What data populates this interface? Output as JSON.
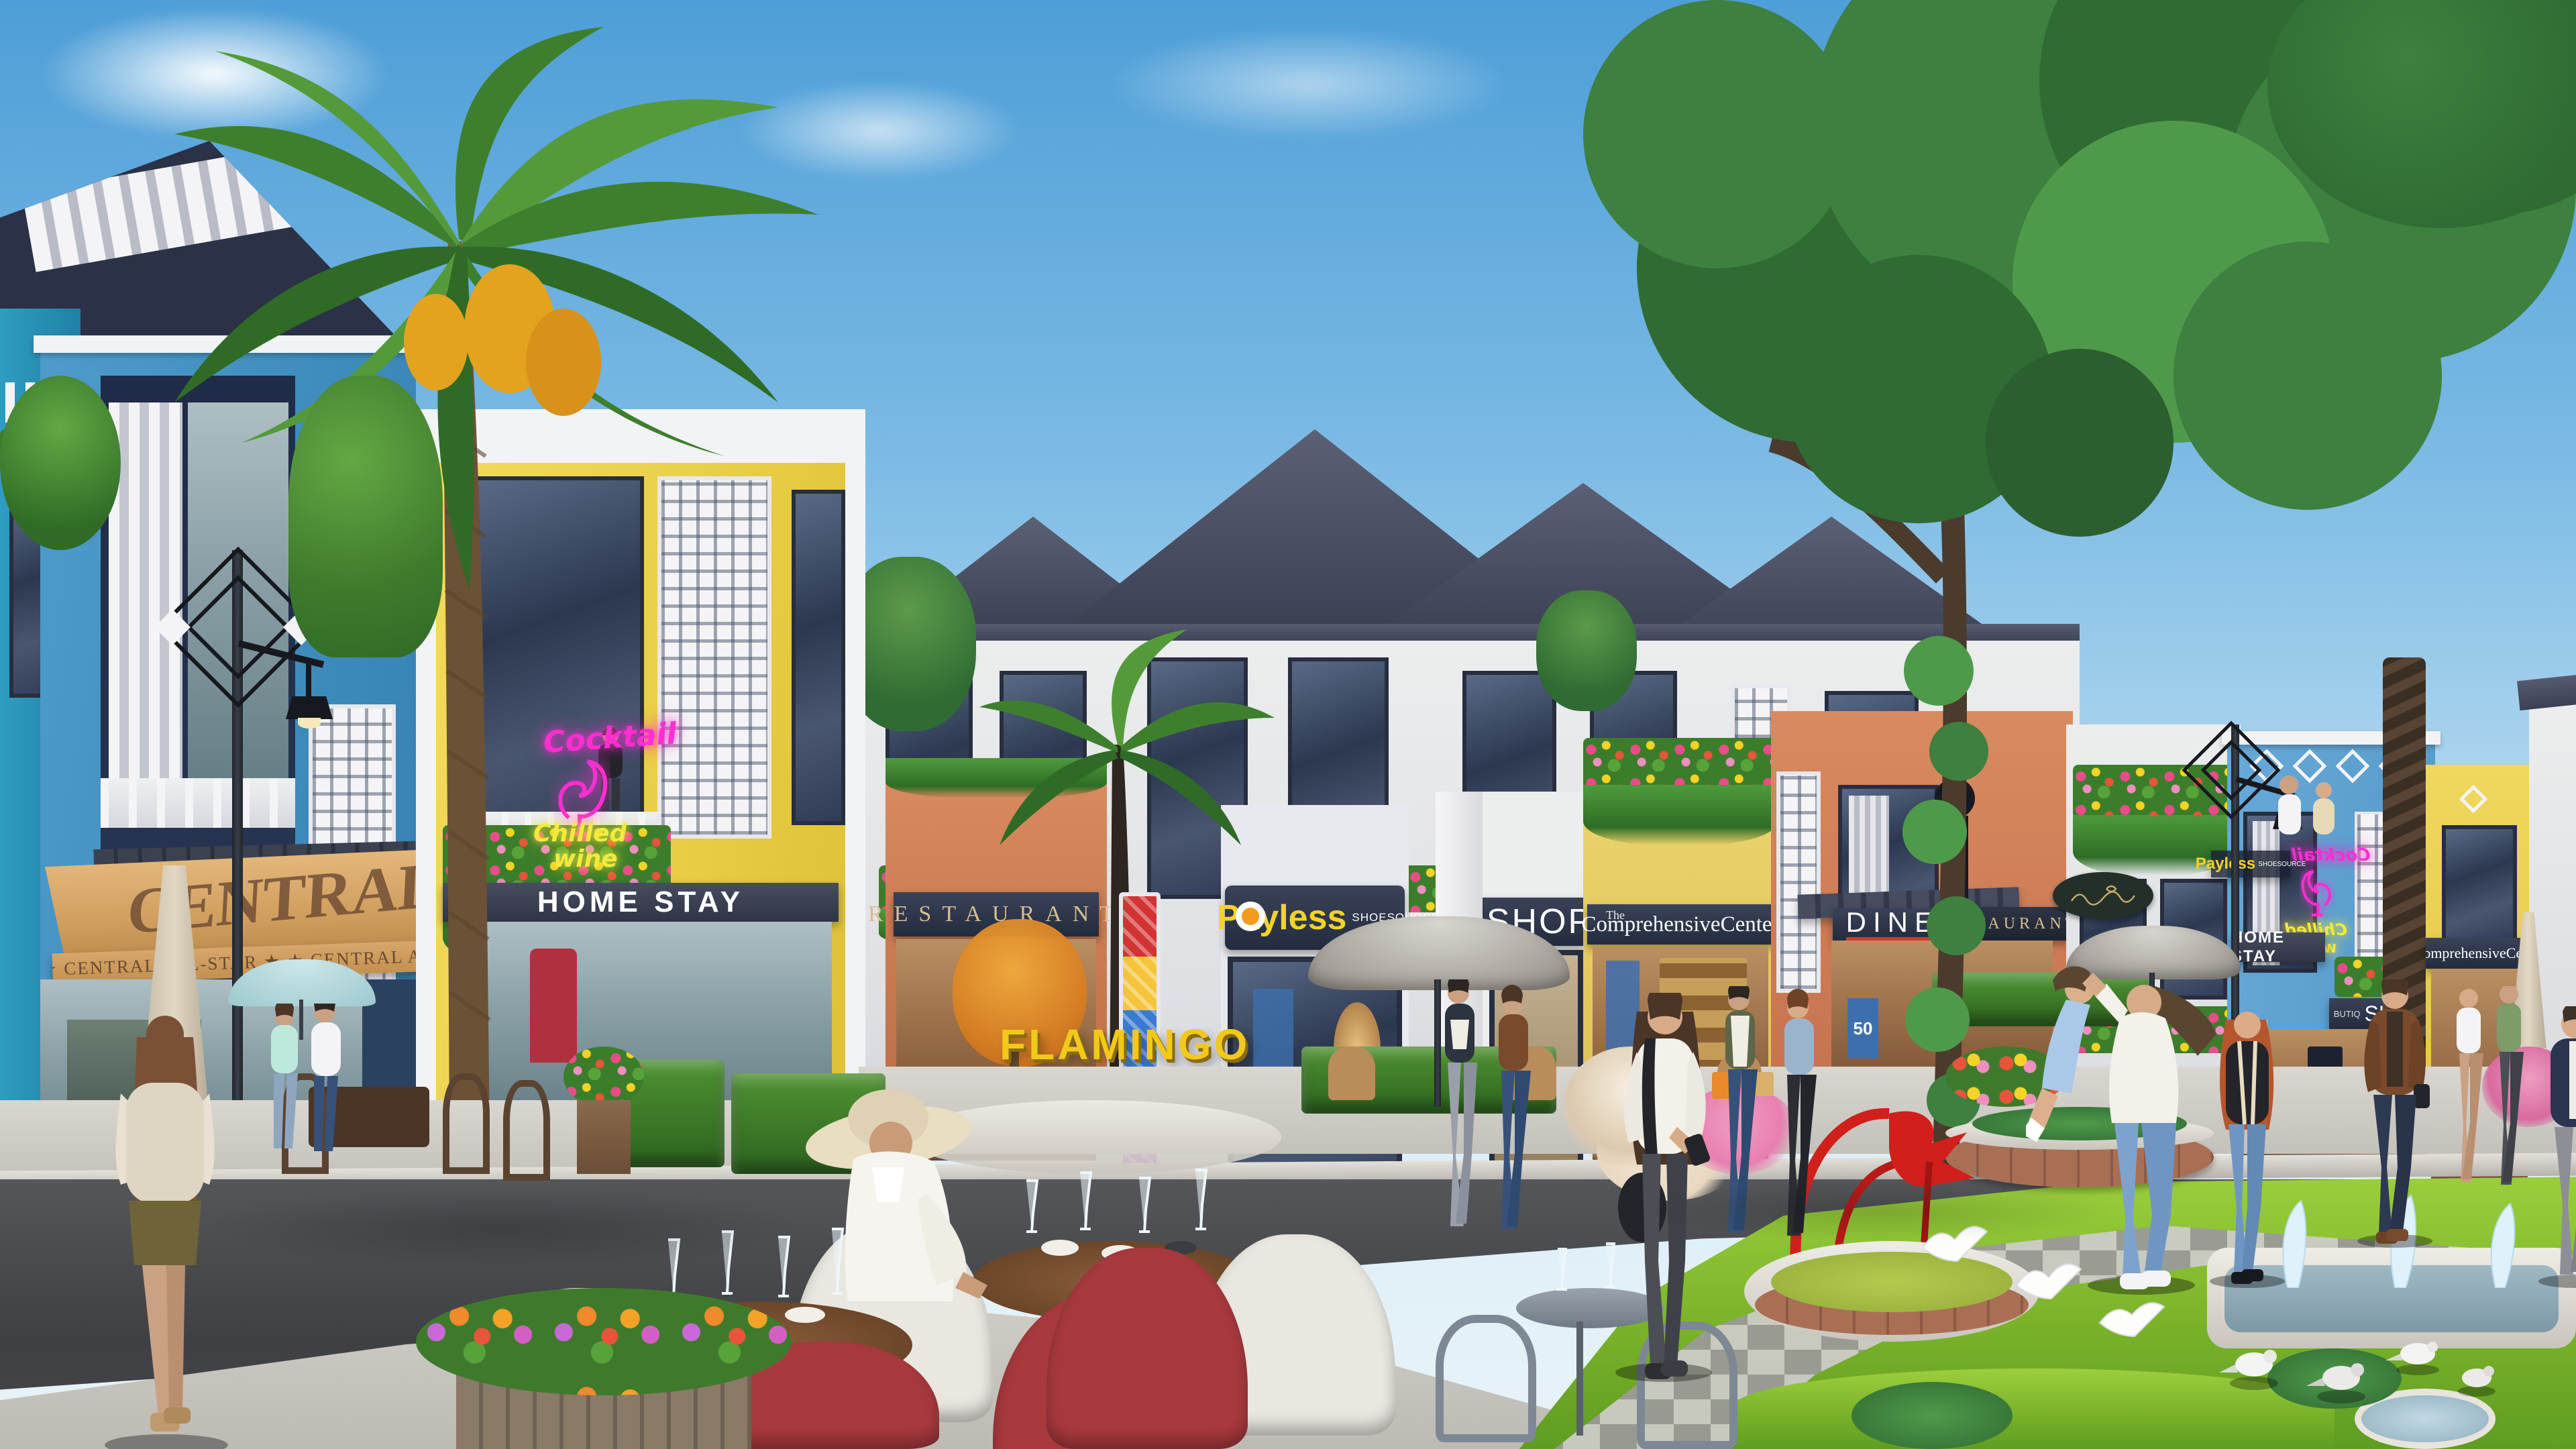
{
  "meta": {
    "title": "Flamingo Tan Trao shophouse street — architectural rendering",
    "scene_description": "Sunny rendered street of colorful 3-storey shophouses with palm trees, outdoor cafe seating, a landscaped park with red sculpture fountain, doves and pedestrians"
  },
  "palette": {
    "sky_top": "#4e9ed7",
    "sky_horizon": "#dceef8",
    "roof_slate": "#3f4355",
    "blue_building": "#3f98c5",
    "light_blue_building": "#8fc3e4",
    "right_blue_building": "#5ea3d4",
    "yellow_building": "#eed34f",
    "orange_building": "#d4835c",
    "awning_tan": "#d7a76b",
    "grass_green": "#7fba2e",
    "asphalt": "#46474b",
    "pavement": "#cfcdc8",
    "neon_pink": "#ff2ed2",
    "neon_yellow": "#f4ea3d",
    "sculpture_red": "#d11f1c",
    "sign_navy": "#232c3f",
    "sign_gold": "#d7bf8e",
    "monument_yellow": "#f2c918"
  },
  "signs": {
    "awning_main": "CENTRAL ALL",
    "awning_valance": "★ ★ CENTRAL ALL-STAR ★ ★ CENTRAL ALL-STAR ★ ★ CENT",
    "neon_cocktail": "Cocktail",
    "neon_chilled": "Chilled",
    "neon_wine": "wine",
    "homestay": "HOME STAY",
    "restaurant": "RESTAURANT",
    "payless": "Payless",
    "shoesource": "SHOESOURCE",
    "butiq": "BUTIQ",
    "shop": "SHOP",
    "comprehensive_the": "The",
    "comprehensive": "ComprehensiveCenter",
    "diner": "DINER",
    "central_c": "C",
    "central_rest": "ENTRAL",
    "restaurant_gold": "RESTAURANT",
    "diner_poster": "50"
  },
  "monument": {
    "line1": "FLAMINGO",
    "line2": "TÂN TRÀO"
  }
}
